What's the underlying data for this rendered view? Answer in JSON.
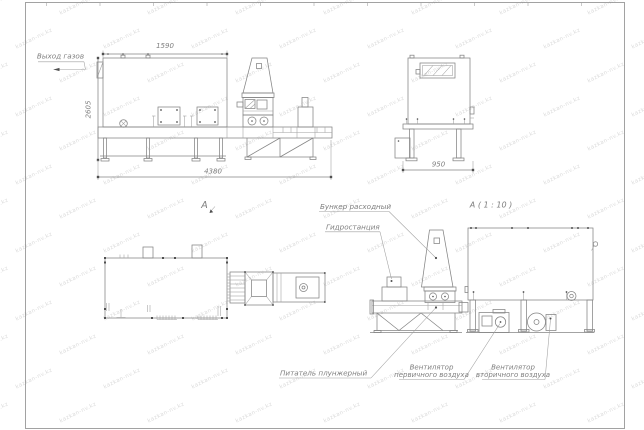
{
  "watermark": {
    "text": "kazkan-nv.kz"
  },
  "labels": {
    "gas_outlet": "Выход газов",
    "view_a": "А",
    "detail_a": "А ( 1 : 10 )",
    "hopper": "Бункер расходный",
    "hydrostation": "Гидростанция",
    "feeder": "Питатель плунжерный",
    "fan_primary_line1": "Вентилятор",
    "fan_primary_line2": "первичного воздуха",
    "fan_secondary_line1": "Вентилятор",
    "fan_secondary_line2": "вторичного воздуха"
  },
  "dimensions": {
    "boiler_length": "1590",
    "overall_height": "2605",
    "overall_length": "4380",
    "side_width": "950"
  },
  "colors": {
    "line": "#848484",
    "text": "#7e7e7e",
    "dot": "#4f4f4f",
    "watermark": "#dcdcdc",
    "background": "#ffffff"
  }
}
